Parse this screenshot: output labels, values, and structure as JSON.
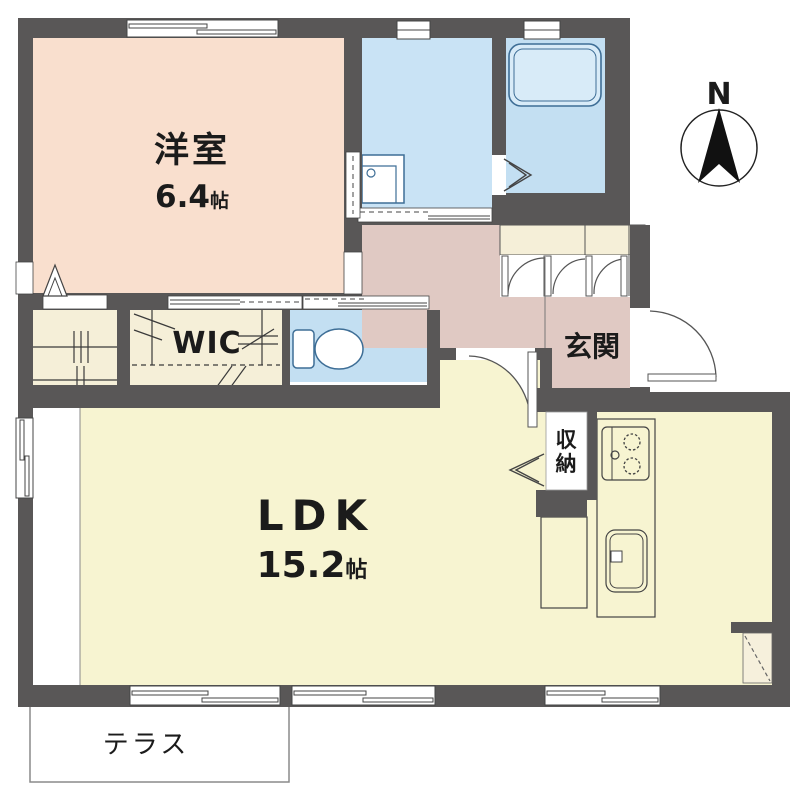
{
  "rooms": {
    "western": {
      "label": "洋室",
      "size_value": "6.4",
      "size_unit": "帖"
    },
    "ldk": {
      "label": "LDK",
      "size_value": "15.2",
      "size_unit": "帖"
    },
    "wic": {
      "label": "WIC"
    },
    "entrance": {
      "label": "玄関"
    },
    "storage": {
      "char_top": "収",
      "char_bottom": "納"
    },
    "terrace": {
      "label": "テラス"
    }
  },
  "compass": {
    "north_label": "N"
  },
  "colors": {
    "wall": "#595757",
    "western_room": "#F9DFCE",
    "hallway": "#E0C9C3",
    "washroom_blue": "#C9E3F5",
    "bath_blue": "#C3DFF2",
    "closet_cream": "#F5EFD8",
    "ldk_yellow": "#F7F4D1",
    "fixture_outline": "#3E6E96"
  }
}
